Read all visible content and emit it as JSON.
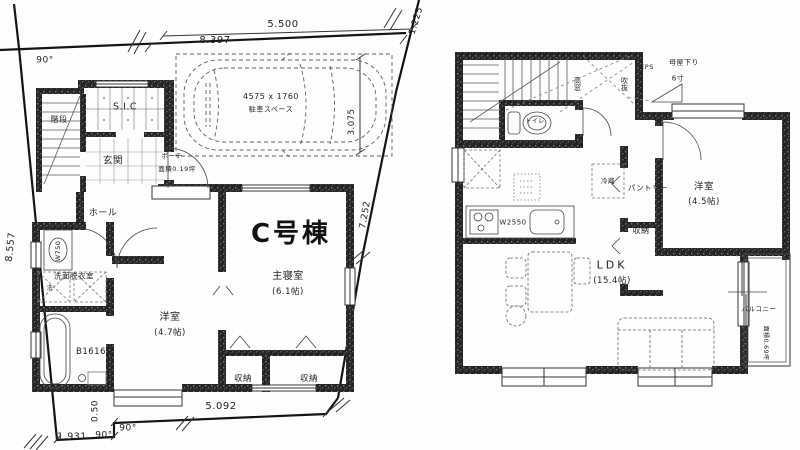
{
  "colors": {
    "wall": "#222222",
    "boundary": "#111111",
    "line": "#3a3a3a"
  },
  "floor1": {
    "title": "C号棟",
    "labels": {
      "stairs": "階段",
      "sic": "S.I.C",
      "entrance": "玄関",
      "porch": "ポーチ",
      "porch_area": "面積0.19坪",
      "hall": "ホール",
      "vanity": "W750",
      "washroom": "洗面脱衣室",
      "washer": "洗",
      "bath": "B1616",
      "bedroom2": "洋室",
      "bedroom2_size": "(4.7帖)",
      "master": "主寝室",
      "master_size": "(6.1帖)",
      "closet_left": "収納",
      "closet_right": "収納"
    },
    "parking": {
      "size": "4575 x 1760",
      "label": "駐車スペース"
    },
    "dimensions": {
      "top_inner": "5.500",
      "top_outer": "8.397",
      "top_right": "1.225",
      "left": "8.557",
      "right_upper": "3.075",
      "right_lower": "7.252",
      "bottom_step": "0.50",
      "bottom_left": "1.931",
      "bottom": "5.092",
      "angle_top": "90°",
      "angle_bottom1": "90°",
      "angle_bottom2": "90°"
    }
  },
  "floor2": {
    "labels": {
      "eps": "EPS",
      "roof": "母屋下り",
      "roof_pitch": "6寸",
      "high_window": "高窓",
      "void": "吹抜",
      "toilet": "トイレ",
      "fridge": "冷蔵",
      "pantry": "パントリー",
      "kitchen": "W2550",
      "ldk": "LDK",
      "ldk_size": "(15.4帖)",
      "closet": "収納",
      "bedroom": "洋室",
      "bedroom_size": "(4.5帖)",
      "balcony": "バルコニー",
      "balcony_area": "面積0.69坪"
    }
  }
}
